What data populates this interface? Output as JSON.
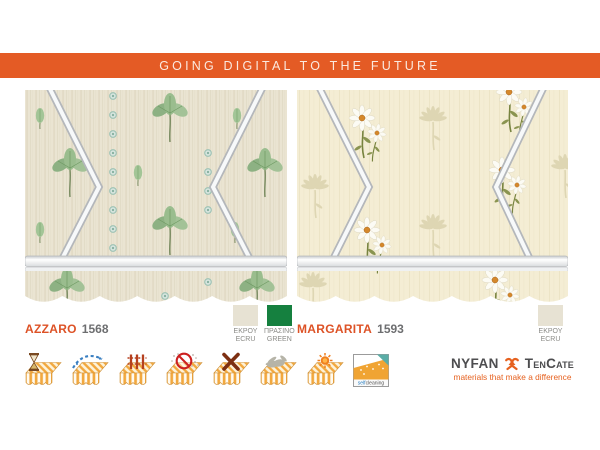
{
  "banner": {
    "title": "GOING DIGITAL TO THE FUTURE",
    "bg_color": "#e45b25"
  },
  "products": [
    {
      "name": "AZZARO",
      "code": "1568",
      "fabric": "green trefoil leaves and small teal dot flowers on ecru awning",
      "swatches": [
        {
          "name_gr": "ΕΚΡΟΥ",
          "name_en": "ECRU",
          "hex": "#e7e2d3"
        },
        {
          "name_gr": "ΠΡΑΣΙΝΟ",
          "name_en": "GREEN",
          "hex": "#15803f"
        }
      ]
    },
    {
      "name": "MARGARITA",
      "code": "1593",
      "fabric": "white daisies with tonal silhouette flowers on cream awning",
      "swatches": [
        {
          "name_gr": "ΕΚΡΟΥ",
          "name_en": "ECRU",
          "hex": "#e7e2d3"
        }
      ]
    }
  ],
  "features": {
    "icons": [
      "hourglass",
      "water-drops",
      "weave-fence",
      "no-dirt",
      "cross",
      "hand",
      "sun",
      "selfcleaning"
    ],
    "selfcleaning": {
      "part1": "self",
      "part2": "cleaning"
    }
  },
  "logo": {
    "name1": "NYFAN",
    "name2": "TenCate",
    "tagline": "materials that make a difference",
    "accent": "#e6611f"
  }
}
